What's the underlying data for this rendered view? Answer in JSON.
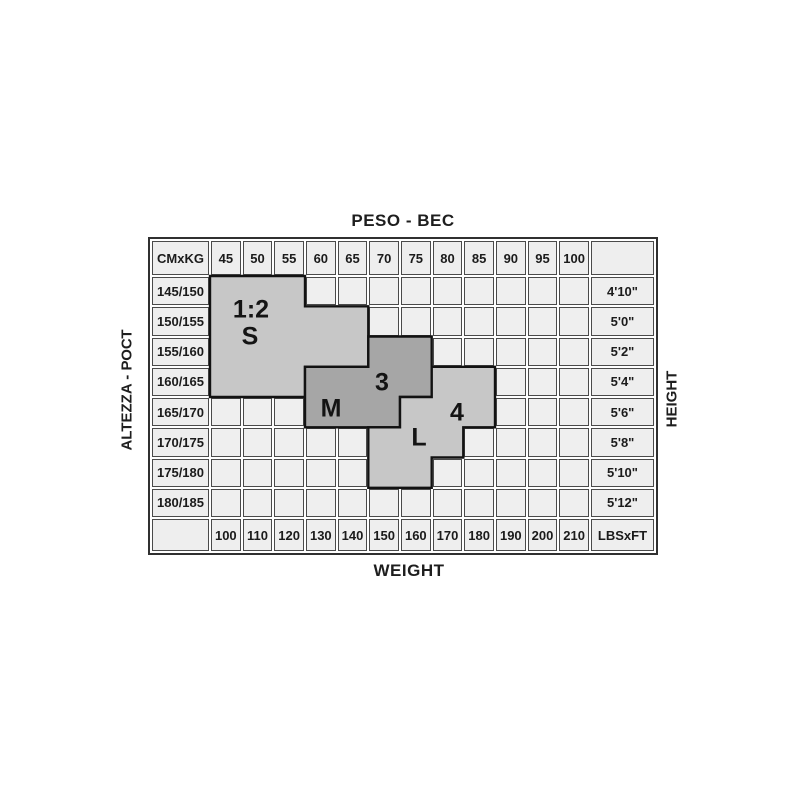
{
  "labels": {
    "top": "PESO - ВЕС",
    "bottom": "WEIGHT",
    "left": "ALTEZZA - РОСТ",
    "right": "HEIGHT"
  },
  "table": {
    "corner_top_left": "CMxKG",
    "corner_bottom_right": "LBSxFT",
    "kg_values": [
      "45",
      "50",
      "55",
      "60",
      "65",
      "70",
      "75",
      "80",
      "85",
      "90",
      "95",
      "100"
    ],
    "lbs_values": [
      "100",
      "110",
      "120",
      "130",
      "140",
      "150",
      "160",
      "170",
      "180",
      "190",
      "200",
      "210"
    ],
    "cm_values": [
      "145/150",
      "150/155",
      "155/160",
      "160/165",
      "165/170",
      "170/175",
      "175/180",
      "180/185"
    ],
    "ft_values": [
      "4'10\"",
      "5'0\"",
      "5'2\"",
      "5'4\"",
      "5'6\"",
      "5'8\"",
      "5'10\"",
      "5'12\""
    ]
  },
  "regions": [
    {
      "id": "s",
      "size_name": "1:2 S",
      "fill": "#c7c7c7",
      "rows": [
        {
          "r": 0,
          "c0": 0,
          "c1": 2
        },
        {
          "r": 1,
          "c0": 0,
          "c1": 4
        },
        {
          "r": 2,
          "c0": 0,
          "c1": 4
        },
        {
          "r": 3,
          "c0": 0,
          "c1": 2
        }
      ],
      "labels": [
        {
          "text": "1:2",
          "x": 101,
          "y": 71
        },
        {
          "text": "S",
          "x": 100,
          "y": 98
        }
      ]
    },
    {
      "id": "m",
      "size_name": "M 3",
      "fill": "#a6a6a6",
      "rows": [
        {
          "r": 2,
          "c0": 5,
          "c1": 6
        },
        {
          "r": 3,
          "c0": 3,
          "c1": 6
        },
        {
          "r": 4,
          "c0": 3,
          "c1": 5
        }
      ],
      "labels": [
        {
          "text": "3",
          "x": 232,
          "y": 144
        },
        {
          "text": "M",
          "x": 181,
          "y": 170
        }
      ]
    },
    {
      "id": "l",
      "size_name": "4 L",
      "fill": "#c7c7c7",
      "rows": [
        {
          "r": 3,
          "c0": 7,
          "c1": 8
        },
        {
          "r": 4,
          "c0": 6,
          "c1": 8
        },
        {
          "r": 5,
          "c0": 5,
          "c1": 7
        },
        {
          "r": 6,
          "c0": 5,
          "c1": 6
        }
      ],
      "labels": [
        {
          "text": "4",
          "x": 307,
          "y": 174
        },
        {
          "text": "L",
          "x": 269,
          "y": 199
        }
      ]
    }
  ],
  "colors": {
    "background": "#ffffff",
    "cell_bg": "#efefef",
    "header_bg": "#eeeeee",
    "grid_line": "#4a4a4a",
    "outer_border": "#303030",
    "region_light": "#c7c7c7",
    "region_dark": "#a6a6a6",
    "region_outline": "#121212",
    "text": "#1a1a1a"
  },
  "chart_data": {
    "type": "table",
    "title": "Hosiery size chart — height vs weight",
    "x_axis": {
      "top_label": "PESO - ВЕС",
      "bottom_label": "WEIGHT",
      "kg_ticks": [
        45,
        50,
        55,
        60,
        65,
        70,
        75,
        80,
        85,
        90,
        95,
        100
      ],
      "lbs_ticks": [
        100,
        110,
        120,
        130,
        140,
        150,
        160,
        170,
        180,
        190,
        200,
        210
      ],
      "unit_corner_top": "CMxKG",
      "unit_corner_bottom": "LBSxFT"
    },
    "y_axis": {
      "left_label": "ALTEZZA - РОСТ",
      "right_label": "HEIGHT",
      "cm_ticks": [
        "145/150",
        "150/155",
        "155/160",
        "160/165",
        "165/170",
        "170/175",
        "175/180",
        "180/185"
      ],
      "ft_ticks": [
        "4'10\"",
        "5'0\"",
        "5'2\"",
        "5'4\"",
        "5'6\"",
        "5'8\"",
        "5'10\"",
        "5'12\""
      ]
    },
    "sizes": [
      {
        "size": "1:2 S",
        "shade": "light-gray",
        "coverage_kg_by_height": {
          "145/150": "45-55",
          "150/155": "45-65",
          "155/160": "45-65",
          "160/165": "45-55"
        }
      },
      {
        "size": "M 3",
        "shade": "dark-gray",
        "coverage_kg_by_height": {
          "155/160": "70-75",
          "160/165": "60-75",
          "165/170": "60-70"
        }
      },
      {
        "size": "4 L",
        "shade": "light-gray",
        "coverage_kg_by_height": {
          "160/165": "80-85",
          "165/170": "75-85",
          "170/175": "70-80",
          "175/180": "70-75"
        }
      }
    ],
    "legend_position": "none",
    "grid": true
  }
}
